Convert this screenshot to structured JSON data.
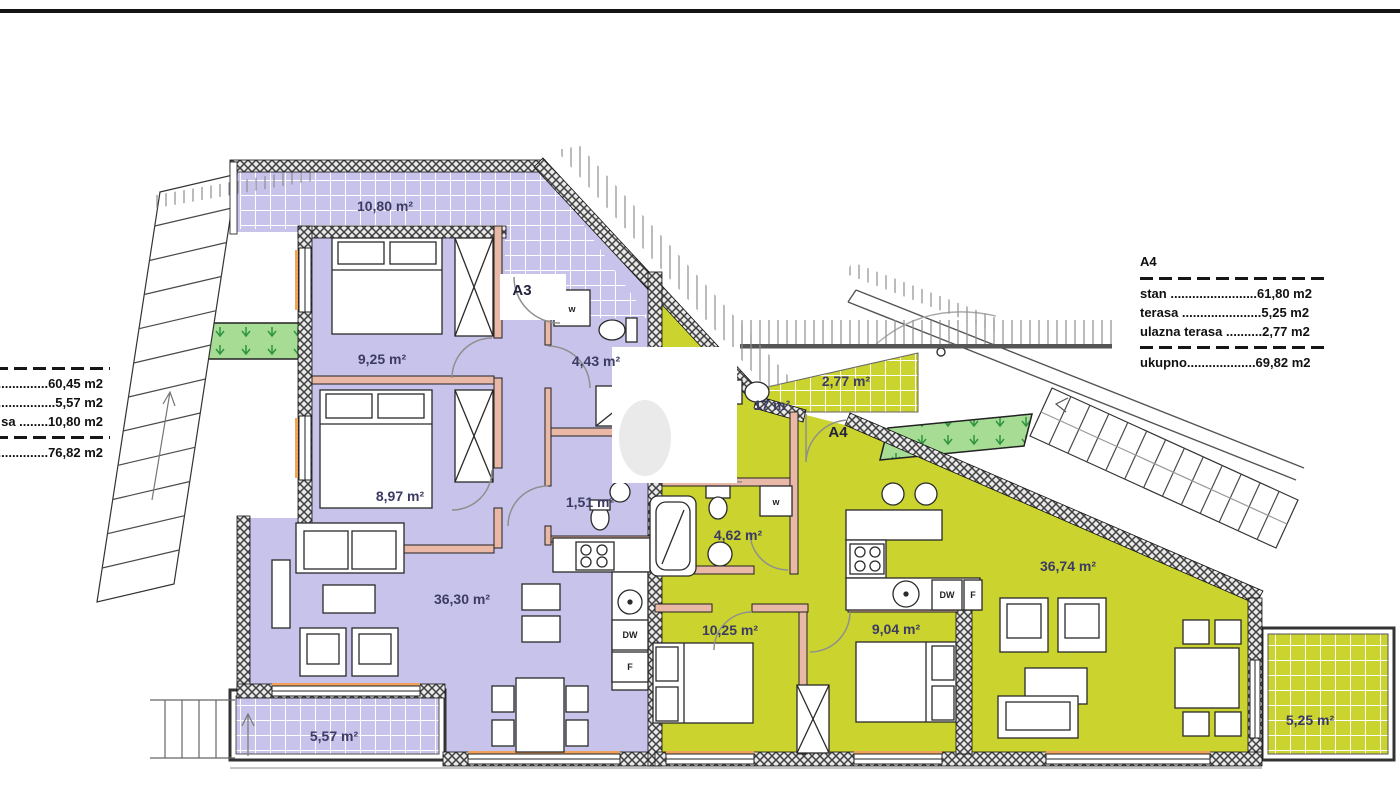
{
  "legend_a3": {
    "line_60": "..............60,45 m2",
    "line_5": "................5,57 m2",
    "line_10": "sa ........10,80 m2",
    "line_total": "..............76,82 m2"
  },
  "legend_a4": {
    "title": "A4",
    "stan": "stan ........................61,80 m2",
    "terasa": "terasa ......................5,25 m2",
    "ulazna": "ulazna terasa ..........2,77 m2",
    "ukupno": "ukupno...................69,82 m2"
  },
  "a3": {
    "code": "A3",
    "terrace_top": "10,80 m²",
    "bedroom_top": "9,25 m²",
    "bedroom_bottom": "8,97 m²",
    "bathroom": "4,43 m²",
    "wc": "1,51 m²",
    "living": "36,30 m²",
    "terrace_bottom": "5,57 m²"
  },
  "a4": {
    "code": "A4",
    "entry_terrace": "2,77 m²",
    "wc": "17 m²",
    "bathroom": "4,62 m²",
    "bedroom_left": "10,25 m²",
    "bedroom_right": "9,04 m²",
    "living": "36,74 m²",
    "terrace": "5,25 m²"
  },
  "appliances": {
    "washer_a3": "w",
    "washer_a4": "w",
    "dishwasher_a3": "DW",
    "fridge_a3": "F",
    "dishwasher_a4": "DW",
    "fridge_a4": "F"
  },
  "colors": {
    "apartment_a3": "#c7c3ea",
    "apartment_a4": "#cbd32e",
    "planter": "#a7dc95",
    "wall": "#3f3f3f",
    "sill_accent": "#f0a25a"
  }
}
